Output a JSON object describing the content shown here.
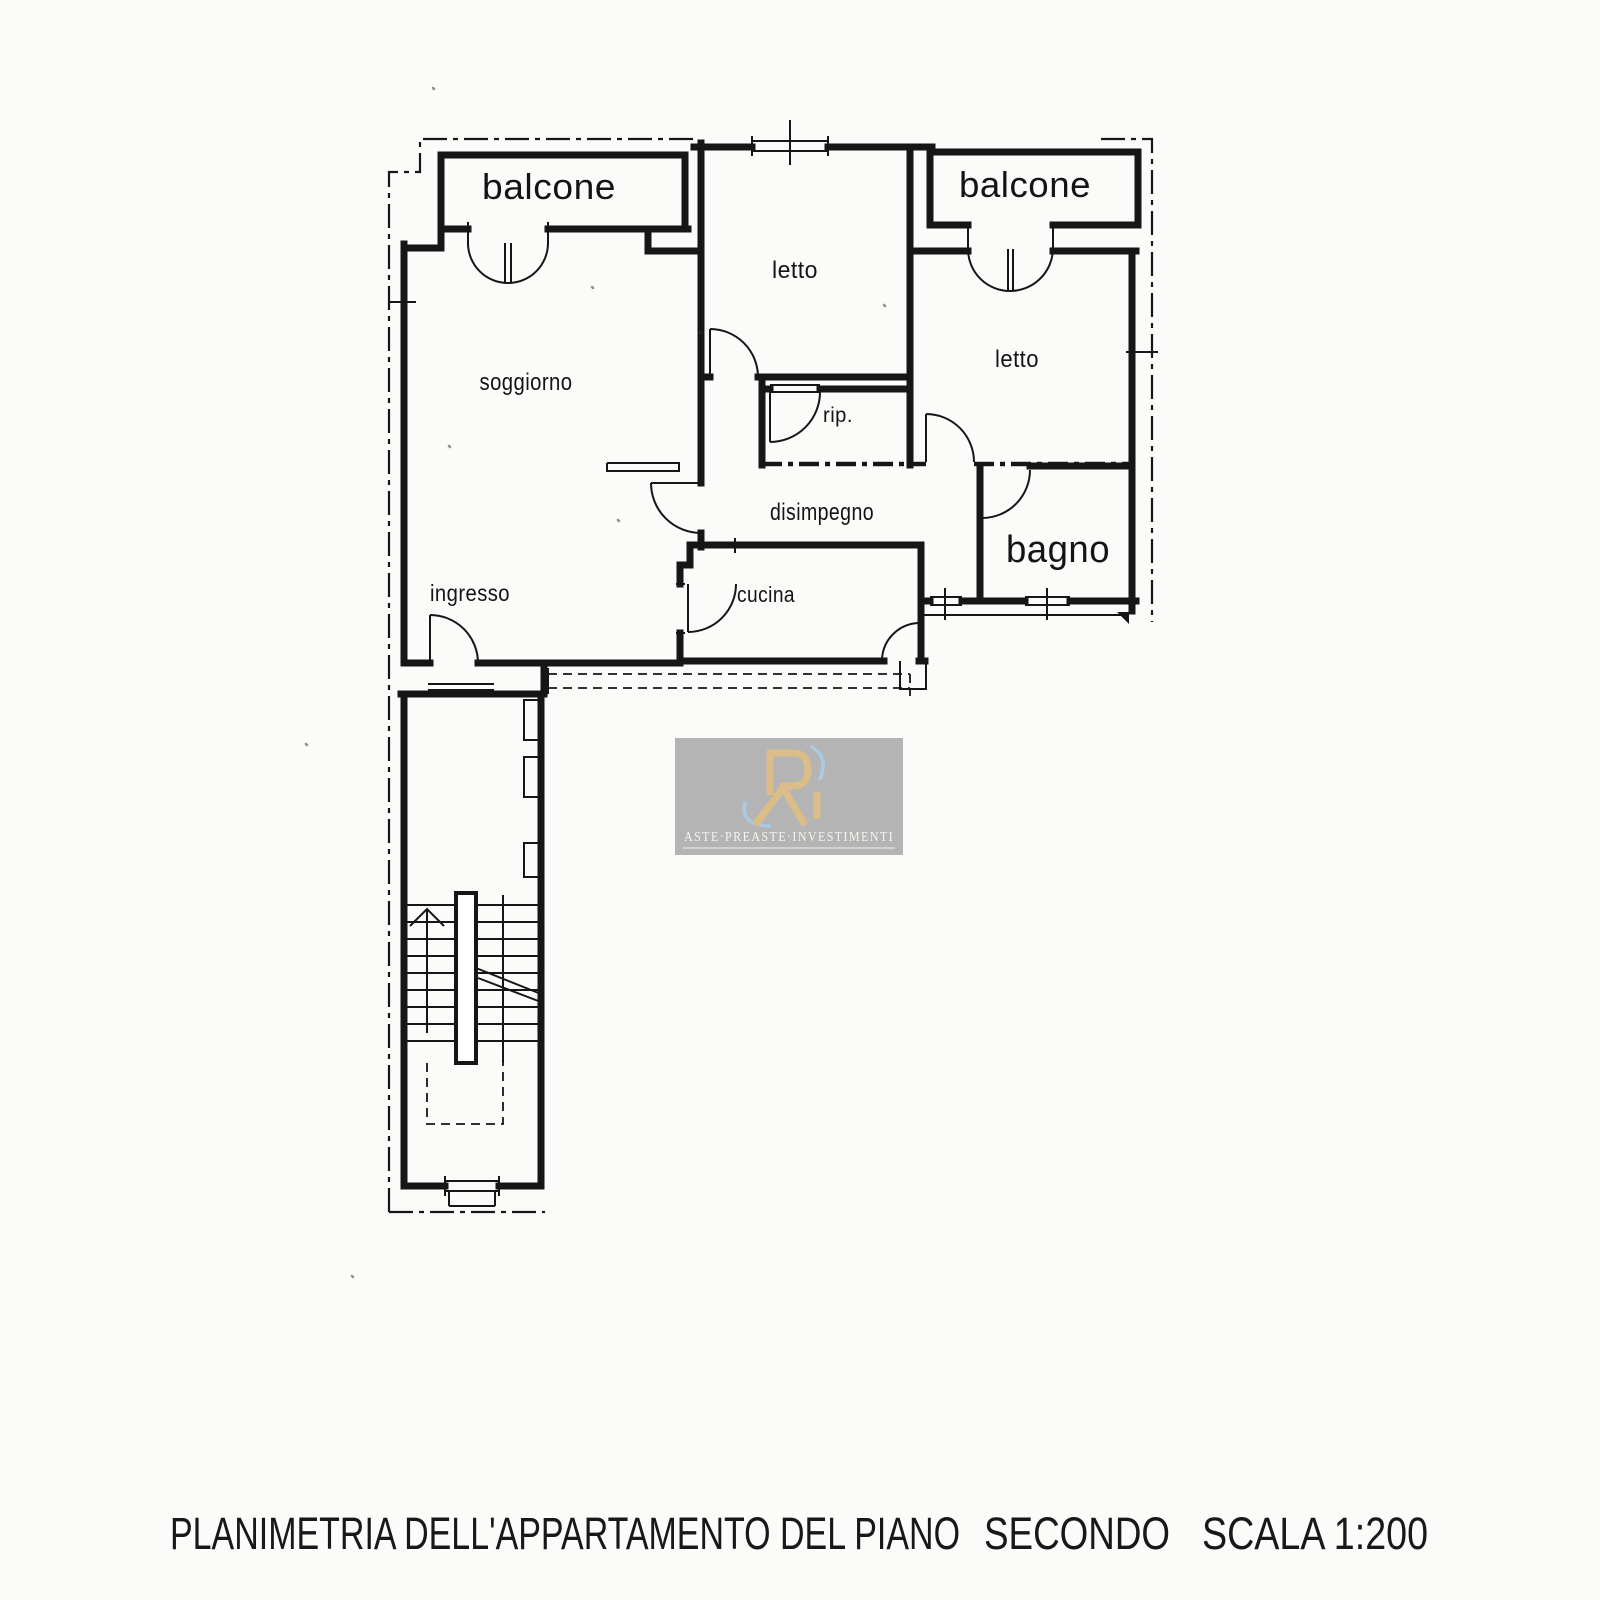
{
  "canvas": {
    "background": "#fbfbf9",
    "ink": "#161616"
  },
  "plan": {
    "rooms": {
      "balcone_left": "balcone",
      "balcone_right": "balcone",
      "letto_middle": "letto",
      "letto_right": "letto",
      "soggiorno": "soggiorno",
      "ripostiglio": "rip.",
      "disimpegno": "disimpegno",
      "bagno": "bagno",
      "cucina": "cucina",
      "ingresso": "ingresso"
    }
  },
  "watermark": {
    "brand_text": "ASTE·PREASTE·INVESTIMENTI",
    "panel_color": "#b4b4b4",
    "logo_gold": "#dcbd88",
    "logo_blue": "#a9cde9",
    "text_color": "#f6f4ee"
  },
  "caption": {
    "title": "PLANIMETRIA DELL'APPARTAMENTO DEL PIANO",
    "floor": "SECONDO",
    "scale": "SCALA 1:200"
  }
}
